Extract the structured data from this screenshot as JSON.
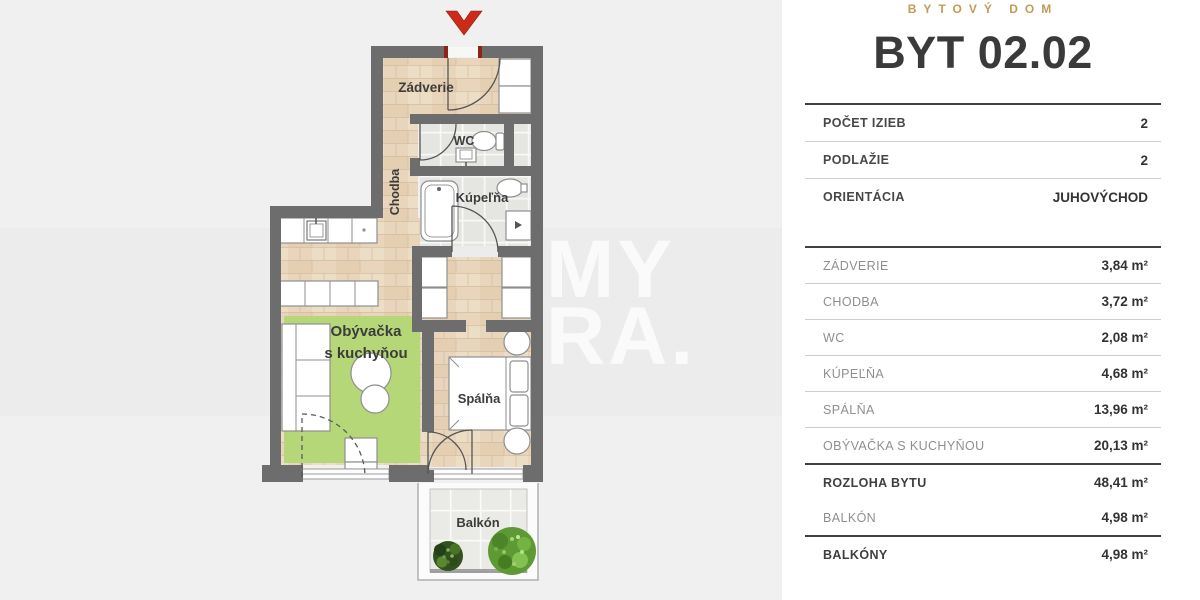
{
  "header": {
    "brand": "BYTOVÝ DOM",
    "title": "BYT 02.02"
  },
  "info_rows": [
    {
      "label": "POČET IZIEB",
      "value": "2"
    },
    {
      "label": "PODLAŽIE",
      "value": "2"
    },
    {
      "label": "ORIENTÁCIA",
      "value": "JUHOVÝCHOD"
    }
  ],
  "area_rows": [
    {
      "label": "ZÁDVERIE",
      "value": "3,84 m²",
      "emphasis": false
    },
    {
      "label": "CHODBA",
      "value": "3,72 m²",
      "emphasis": false
    },
    {
      "label": "WC",
      "value": "2,08 m²",
      "emphasis": false
    },
    {
      "label": "KÚPEĽŇA",
      "value": "4,68 m²",
      "emphasis": false
    },
    {
      "label": "SPÁLŇA",
      "value": "13,96 m²",
      "emphasis": false
    },
    {
      "label": "OBÝVAČKA S KUCHYŇOU",
      "value": "20,13 m²",
      "emphasis": false
    },
    {
      "label": "ROZLOHA BYTU",
      "value": "48,41 m²",
      "emphasis": true
    },
    {
      "label": "BALKÓN",
      "value": "4,98 m²",
      "emphasis": false
    },
    {
      "label": "BALKÓNY",
      "value": "4,98 m²",
      "emphasis": true
    }
  ],
  "floorplan": {
    "labels": {
      "zadverie": "Zádverie",
      "chodba": "Chodba",
      "wc": "WC",
      "kupelna": "Kúpeľňa",
      "obyvacka_line1": "Obývačka",
      "obyvacka_line2": "s kuchyňou",
      "spalna": "Spálňa",
      "balkon": "Balkón"
    },
    "watermark": {
      "line1": "MY",
      "line2": "RA."
    }
  },
  "colors": {
    "accent_gold": "#c49a58",
    "wall_gray": "#6d6d6d",
    "rug_green": "#b6d778",
    "entrance_red": "#cd2a1a",
    "wood_floor": "#e7d4bb",
    "tile_floor": "#e9e9e6",
    "text_dark": "#3a3a3a",
    "label_gray": "#8f8f8f"
  }
}
